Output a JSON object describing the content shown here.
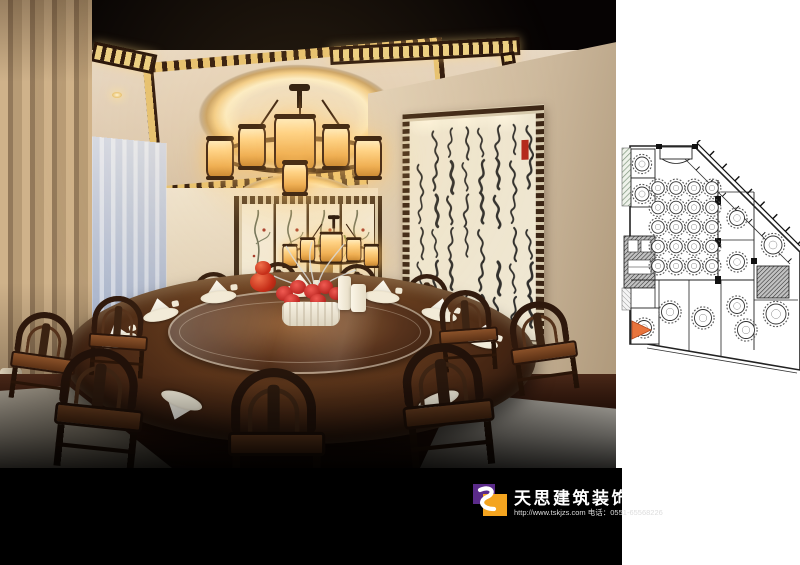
{
  "branding": {
    "company_name": "天思建筑装饰",
    "contact_line": "http://www.tskjzs.com 电话：0551-65568226",
    "logo_colors": {
      "purple": "#5b2b8a",
      "orange": "#f4a41f",
      "swoosh": "#ffffff"
    },
    "bar_background": "#000000"
  },
  "rendering": {
    "subject": "chinese-restaurant-private-dining-room",
    "palette": {
      "ceiling_glow": "#fdf2cf",
      "lattice_gold": "#e6c271",
      "wood_dark": "#2e190d",
      "curtain_tan": "#c3a67f",
      "window_blue": "#aab6cf",
      "flower_red": "#c62828",
      "marble_grey": "#b7b3aa",
      "seal_red": "#b3271a"
    }
  },
  "floor_plan": {
    "background": "#ffffff",
    "line_color": "#222222",
    "marker_color": "#e8743c",
    "main_hall_tables": {
      "columns": 4,
      "rows": 5
    }
  }
}
